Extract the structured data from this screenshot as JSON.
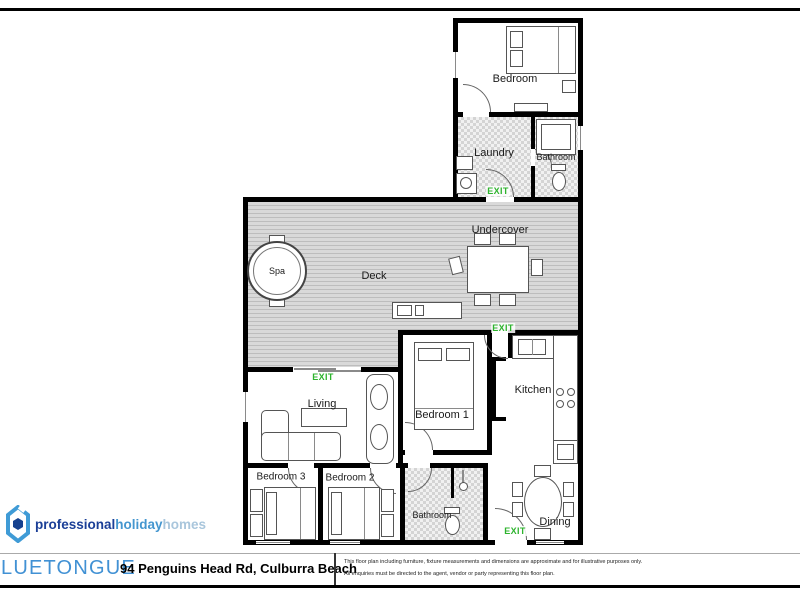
{
  "plan": {
    "rooms": [
      {
        "id": "bedroom-top",
        "label": "Bedroom"
      },
      {
        "id": "laundry",
        "label": "Laundry"
      },
      {
        "id": "bathroom-upper",
        "label": "Bathroom"
      },
      {
        "id": "undercover",
        "label": "Undercover"
      },
      {
        "id": "deck",
        "label": "Deck"
      },
      {
        "id": "spa",
        "label": "Spa"
      },
      {
        "id": "living",
        "label": "Living"
      },
      {
        "id": "bedroom-1",
        "label": "Bedroom 1"
      },
      {
        "id": "kitchen",
        "label": "Kitchen"
      },
      {
        "id": "bedroom-3",
        "label": "Bedroom 3"
      },
      {
        "id": "bedroom-2",
        "label": "Bedroom 2"
      },
      {
        "id": "bathroom-lower",
        "label": "Bathroom"
      },
      {
        "id": "dining",
        "label": "Dining"
      }
    ],
    "exit_label": "EXIT",
    "colors": {
      "exit_green": "#2db32d",
      "wall_black": "#000000",
      "deck_gray": "#cccccc",
      "tile_gray": "#e3e3e3"
    }
  },
  "logo": {
    "brand_bold": "professional",
    "brand_mid": "holiday",
    "brand_light": "homes",
    "colors": {
      "dark_blue": "#1b3f97",
      "mid_blue": "#4496cf",
      "light_blue": "#a9c6dc"
    }
  },
  "footer": {
    "property_name": "LUETONGUE",
    "address": "94 Penguins Head Rd, Culburra Beach",
    "disclaimer_line1": "This floor plan including furniture, fixture measurements and dimensions are approximate and for illustrative purposes only.",
    "disclaimer_line2": "All enquiries must be directed to the agent, vendor or party representing this floor plan."
  }
}
